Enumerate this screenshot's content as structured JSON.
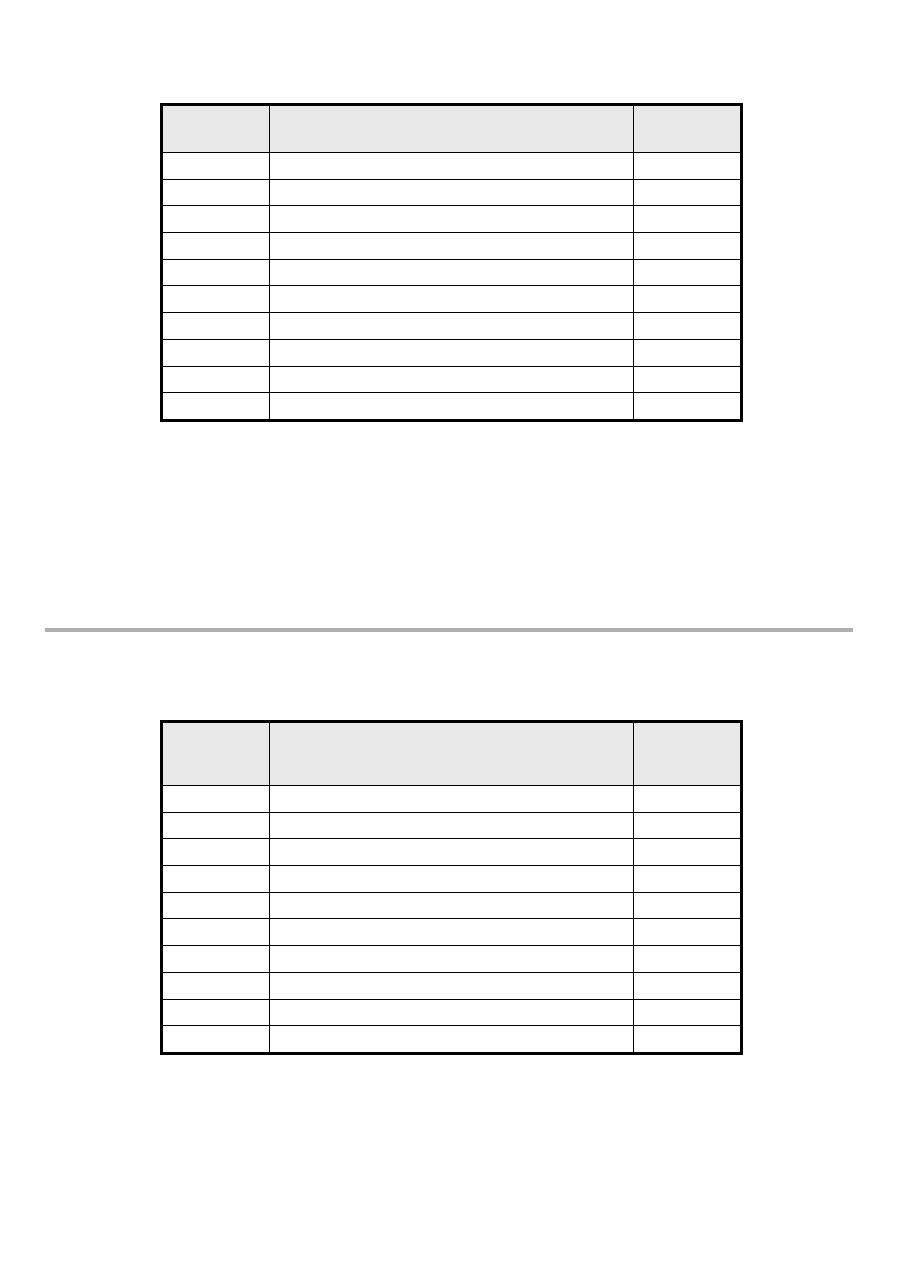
{
  "colors": {
    "page_bg": "#ffffff",
    "table_border": "#000000",
    "header_fill": "#e8e8e8",
    "divider_rule": "#b0b0b0"
  },
  "top_table": {
    "header_cells": [
      "",
      "",
      ""
    ],
    "rows": [
      [
        "",
        "",
        ""
      ],
      [
        "",
        "",
        ""
      ],
      [
        "",
        "",
        ""
      ],
      [
        "",
        "",
        ""
      ],
      [
        "",
        "",
        ""
      ],
      [
        "",
        "",
        ""
      ],
      [
        "",
        "",
        ""
      ],
      [
        "",
        "",
        ""
      ],
      [
        "",
        "",
        ""
      ],
      [
        "",
        "",
        ""
      ]
    ]
  },
  "bottom_table": {
    "header_cells": [
      "",
      "",
      ""
    ],
    "rows": [
      [
        "",
        "",
        ""
      ],
      [
        "",
        "",
        ""
      ],
      [
        "",
        "",
        ""
      ],
      [
        "",
        "",
        ""
      ],
      [
        "",
        "",
        ""
      ],
      [
        "",
        "",
        ""
      ],
      [
        "",
        "",
        ""
      ],
      [
        "",
        "",
        ""
      ],
      [
        "",
        "",
        ""
      ],
      [
        "",
        "",
        ""
      ]
    ]
  }
}
